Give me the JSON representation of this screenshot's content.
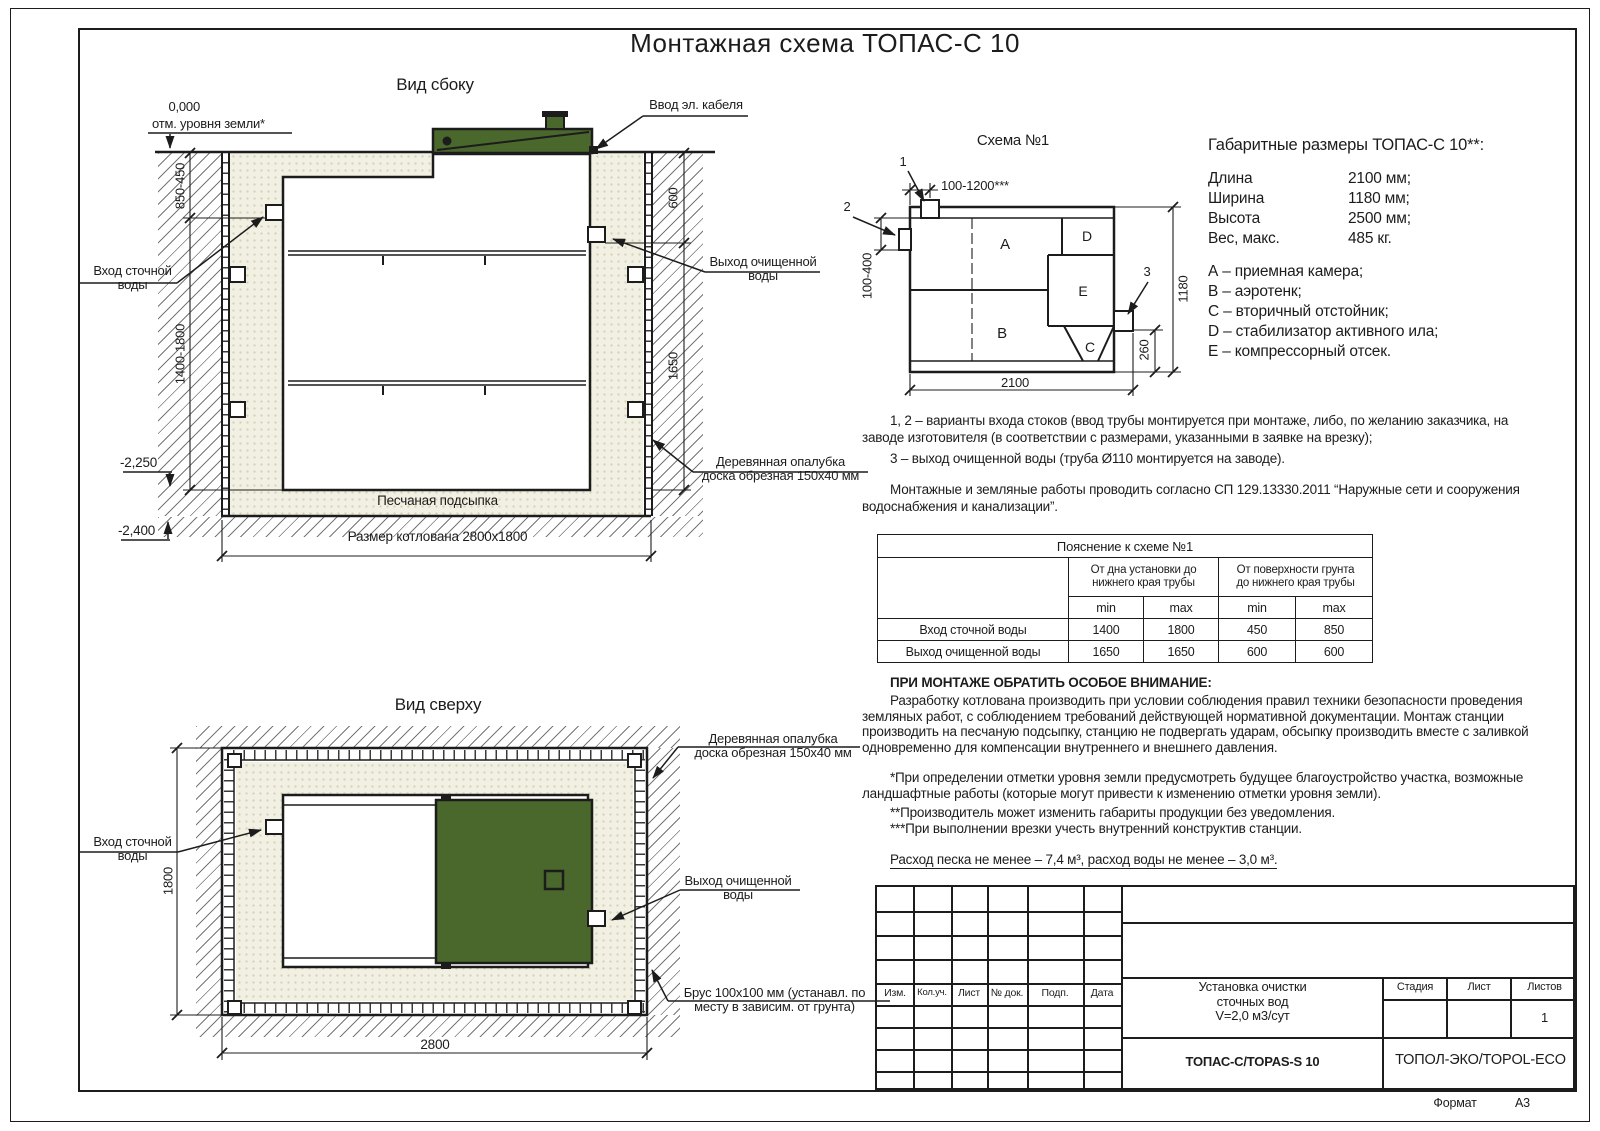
{
  "colors": {
    "ink": "#1c1c1c",
    "green": "#4a682c",
    "sand": "#f2f0e2",
    "sanddot": "#d7d3ba"
  },
  "page": {
    "title": "Монтажная схема ТОПАС-С 10",
    "format_label": "Формат",
    "format_value": "А3"
  },
  "side_view": {
    "title": "Вид сбоку",
    "zero_mark": "0,000",
    "zero_note": "отм. уровня земли*",
    "cable_label": "Ввод эл. кабеля",
    "inlet_label": "Вход сточной\nводы",
    "outlet_label": "Выход очищенной\nводы",
    "formwork_label": "Деревянная опалубка\nдоска обрезная 150x40 мм",
    "sand_label": "Песчаная подсыпка",
    "pit_label": "Размер котлована 2800x1800",
    "dims": {
      "depth_top": "850-450",
      "depth_main": "1400-1800",
      "right_top": "600",
      "right_main": "1650",
      "level_tank": "-2,250",
      "level_pit": "-2,400"
    }
  },
  "top_view": {
    "title": "Вид сверху",
    "inlet_label": "Вход сточной\nводы",
    "outlet_label": "Выход очищенной\nводы",
    "formwork_label": "Деревянная опалубка\nдоска обрезная 150x40 мм",
    "beam_label": "Брус 100x100 мм (устанавл. по\nместу в зависим. от грунта)",
    "dims": {
      "width": "2800",
      "height": "1800"
    }
  },
  "schema": {
    "title": "Схема №1",
    "compartments": [
      "A",
      "B",
      "C",
      "D",
      "E"
    ],
    "callouts": [
      "1",
      "2",
      "3"
    ],
    "dims": {
      "top": "100-1200***",
      "left": "100-400",
      "width": "2100",
      "height": "1180",
      "outlet": "260"
    }
  },
  "specs": {
    "title": "Габаритные размеры ТОПАС-С 10**:",
    "rows": [
      {
        "label": "Длина",
        "value": "2100 мм;"
      },
      {
        "label": "Ширина",
        "value": "1180 мм;"
      },
      {
        "label": "Высота",
        "value": "2500 мм;"
      },
      {
        "label": "Вес, макс.",
        "value": "485 кг."
      }
    ],
    "legend": [
      "А – приемная камера;",
      "B – аэротенк;",
      "C – вторичный отстойник;",
      "D – стабилизатор активного ила;",
      "E – компрессорный отсек."
    ]
  },
  "notes": {
    "note12": "1, 2 – варианты входа стоков (ввод трубы монтируется при монтаже, либо, по желанию заказчика, на заводе изготовителя (в соответствии с размерами, указанными в заявке на врезку);",
    "note3": "3 – выход очищенной воды (труба Ø110 монтируется на заводе).",
    "sp": "Монтажные и земляные работы проводить согласно СП 129.13330.2011 “Наружные сети и сооружения водоснабжения и канализации”."
  },
  "pipe_table": {
    "title": "Пояснение к схеме №1",
    "col_groups": [
      "От дна установки до\nнижнего края трубы",
      "От поверхности грунта\nдо нижнего края трубы"
    ],
    "sub_headers": [
      "min",
      "max",
      "min",
      "max"
    ],
    "rows": [
      {
        "label": "Вход сточной воды",
        "values": [
          "1400",
          "1800",
          "450",
          "850"
        ]
      },
      {
        "label": "Выход очищенной воды",
        "values": [
          "1650",
          "1650",
          "600",
          "600"
        ]
      }
    ]
  },
  "attention": {
    "title": "ПРИ МОНТАЖЕ ОБРАТИТЬ ОСОБОЕ ВНИМАНИЕ:",
    "body": "Разработку котлована производить при условии соблюдения правил техники безопасности проведения земляных работ, с соблюдением требований действующей нормативной документации. Монтаж станции производить на песчаную подсыпку, станцию не подвергать ударам, обсыпку производить вместе с заливкой одновременно для компенсации внутреннего и внешнего давления.",
    "fn1": "*При определении отметки уровня земли предусмотреть будущее благоустройство участка, возможные ландшафтные работы (которые могут привести к изменению отметки уровня земли).",
    "fn2": "**Производитель может изменить габариты продукции без уведомления.",
    "fn3": "***При выполнении врезки учесть внутренний конструктив станции.",
    "consumption": "Расход песка не менее – 7,4 м³, расход воды не менее – 3,0 м³."
  },
  "title_block": {
    "rev_headers": [
      "Изм.",
      "Кол.уч.",
      "Лист",
      "№ док.",
      "Подп.",
      "Дата"
    ],
    "doc_name": "Установка очистки\nсточных вод\nV=2,0 м3/сут",
    "stage_label": "Стадия",
    "sheet_label": "Лист",
    "sheets_label": "Листов",
    "sheets_value": "1",
    "model": "ТОПАС-С/TOPAS-S 10",
    "company": "ТОПОЛ-ЭКО/TOPOL-ECO"
  }
}
